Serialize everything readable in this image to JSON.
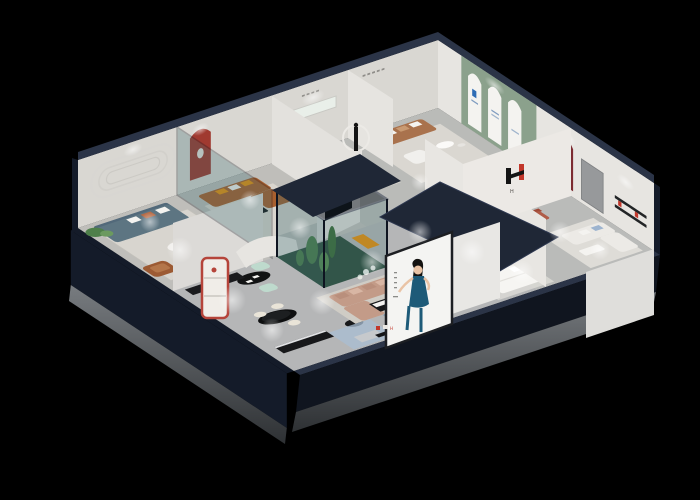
{
  "scene": {
    "type": "3d-isometric-cutaway-render",
    "subject": "Furniture showroom interior, dollhouse cutaway view on black backdrop",
    "brand": {
      "mark": "H"
    },
    "poster": {
      "description": "Fashion model in dark blue evening dress on white facade panel"
    },
    "rooms": [
      {
        "name": "teal-lounge",
        "items": [
          "teal three-seat sofa",
          "round white coffee table",
          "tall plant",
          "oval wall moulding",
          "leather armchair"
        ],
        "accent": "#5d7582"
      },
      {
        "name": "cognac-lounge",
        "items": [
          "cognac leather sectional",
          "red arched niche",
          "glass partition",
          "black coffee table"
        ],
        "accent": "#a9602f"
      },
      {
        "name": "caramel-lounge",
        "items": [
          "caramel sofa",
          "ring-light sculpture",
          "white nesting tables",
          "lit wall niche"
        ],
        "accent": "#b67c4f"
      },
      {
        "name": "arch-gallery-lounge",
        "items": [
          "sage arched display wall",
          "brown leather sofa",
          "white armchair"
        ],
        "accent": "#8ba18c"
      },
      {
        "name": "cactus-atrium",
        "items": [
          "glass box garden",
          "cacti",
          "white flowers"
        ],
        "accent": "#4e7f4a"
      },
      {
        "name": "open-gallery",
        "items": [
          "tan sectional",
          "black oval display table",
          "mint stools",
          "black oval dining table",
          "cream chairs",
          "red display shelf",
          "media consoles",
          "orange bench"
        ],
        "accent": "#c39b88"
      },
      {
        "name": "right-lounge",
        "items": [
          "blue fabric sofa",
          "green sofa",
          "round side table",
          "H logo partition",
          "terracotta arch chair"
        ],
        "accent": "#9db4cf"
      },
      {
        "name": "bedroom-display",
        "items": [
          "white bed",
          "black round rug",
          "cream sectional",
          "red arched niche",
          "wall shelf"
        ],
        "accent": "#7c2b31"
      },
      {
        "name": "front-lounge",
        "items": [
          "blue-gray sofas",
          "ottoman",
          "black round table",
          "facade poster"
        ],
        "accent": "#8ba2b3"
      }
    ]
  },
  "colors": {
    "bg": "#000000",
    "navyTop": "#2b3447",
    "navyDark": "#141b29",
    "navyFace": "#10151f",
    "navyRoof": "#1f2736",
    "plinth": "#63676b",
    "plinthDark": "#3c3f42",
    "wallLight": "#e7e5e1",
    "wallMid": "#d9d7d2",
    "wallShade": "#c8c6c1",
    "floorGray": "#b5b6b7",
    "floorWarm": "#c7c4bd",
    "rug": "#d8d5cf",
    "rugBlue": "#a9bdd3",
    "sage": "#8ba18c",
    "archWhite": "#f4f3f0",
    "tealSofa": "#5d7582",
    "cognac": "#a9602f",
    "caramel": "#b67c4f",
    "brownSofa": "#a9724d",
    "tanSofa": "#c39b88",
    "blueSofa": "#9db4cf",
    "greenSofa": "#9fbfab",
    "mint": "#bedacd",
    "bluegray": "#8ba2b3",
    "orange": "#e89110",
    "redArch": "#a03a30",
    "maroon": "#7c2b31",
    "terracotta": "#b05c48",
    "glassTeal": "#34686c",
    "cactus": "#4e7f4a",
    "plantLight": "#6b9a5f",
    "black": "#17181a",
    "white": "#f4f3f0",
    "posterDress": "#1d5a78",
    "skin": "#e9c3a5",
    "logoRed": "#c2372b",
    "logoBlack": "#141414",
    "blueMark": "#2f6db5"
  }
}
